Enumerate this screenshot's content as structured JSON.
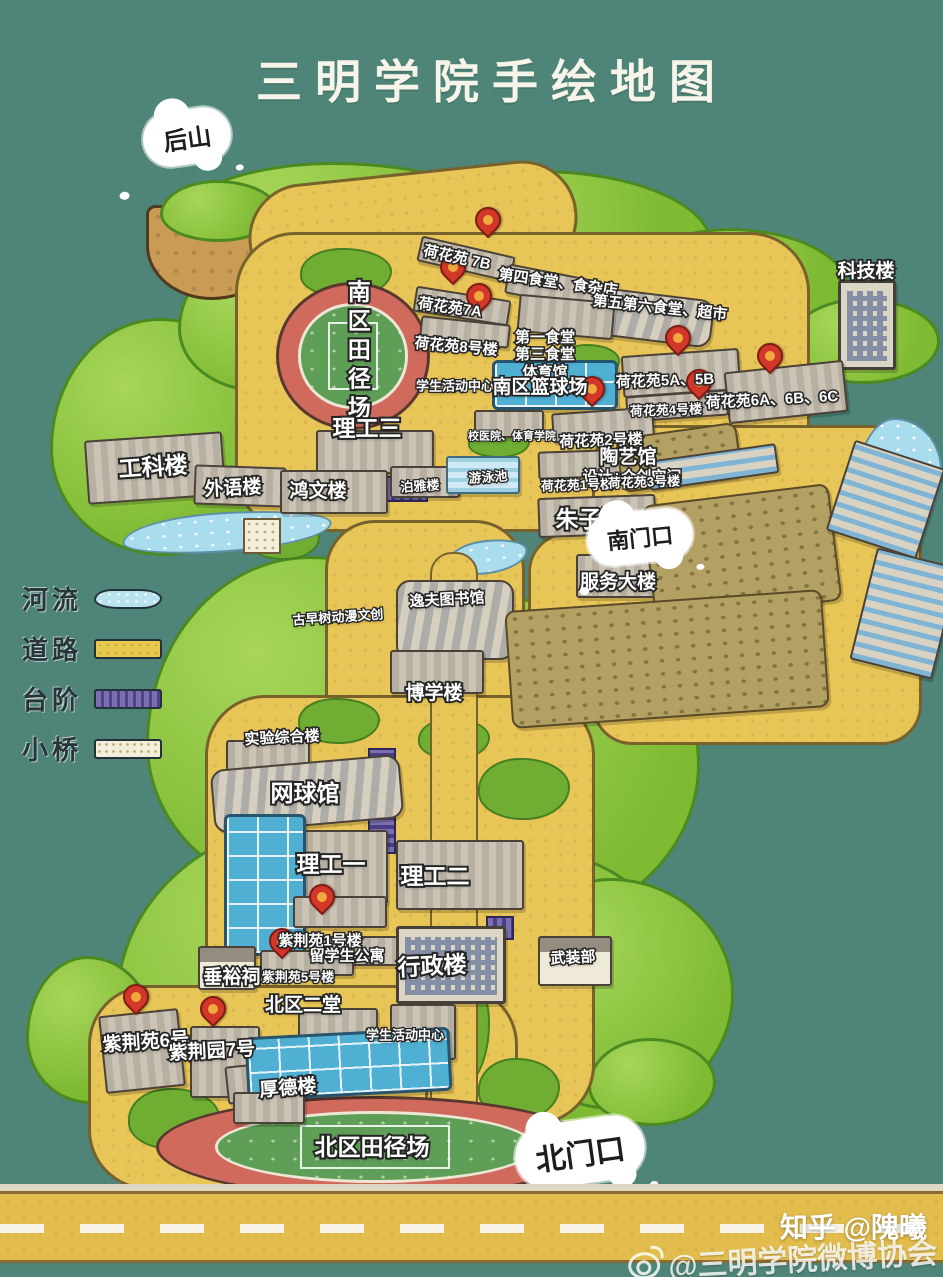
{
  "title": "三明学院手绘地图",
  "colors": {
    "background": "#4f8578",
    "road": "#e8c557",
    "tree": "#7fba33",
    "track": "#cf6a5d",
    "river": "#a9dcec",
    "steps": "#6b5fa3",
    "pin": "#d2372a",
    "bridge": "#f3eeda"
  },
  "legend": {
    "items": [
      {
        "label": "河流",
        "type": "river"
      },
      {
        "label": "道路",
        "type": "road"
      },
      {
        "label": "台阶",
        "type": "steps"
      },
      {
        "label": "小桥",
        "type": "bridge"
      }
    ]
  },
  "clouds": [
    {
      "name": "back-hill-cloud",
      "label": "后山",
      "x": 187,
      "y": 137,
      "fs": 24,
      "rot": -8
    },
    {
      "name": "south-gate-cloud",
      "label": "南门口",
      "x": 640,
      "y": 537,
      "fs": 22,
      "rot": -6
    },
    {
      "name": "north-gate-cloud",
      "label": "北门口",
      "x": 580,
      "y": 1152,
      "fs": 30,
      "rot": -8
    }
  ],
  "watermarks": {
    "zhihu": "知乎 @隗曦",
    "weibo": "@三明学院微博协会"
  },
  "map": {
    "greens": [
      {
        "x": 148,
        "y": 162,
        "w": 385,
        "h": 162
      },
      {
        "x": 378,
        "y": 170,
        "w": 335,
        "h": 152
      },
      {
        "x": 618,
        "y": 228,
        "w": 232,
        "h": 125
      },
      {
        "x": 788,
        "y": 298,
        "w": 152,
        "h": 86
      },
      {
        "x": 50,
        "y": 318,
        "w": 228,
        "h": 238
      },
      {
        "x": 178,
        "y": 252,
        "w": 162,
        "h": 140
      },
      {
        "x": 146,
        "y": 556,
        "w": 342,
        "h": 342
      },
      {
        "x": 328,
        "y": 598,
        "w": 372,
        "h": 332
      },
      {
        "x": 116,
        "y": 818,
        "w": 432,
        "h": 332
      },
      {
        "x": 376,
        "y": 848,
        "w": 312,
        "h": 292
      },
      {
        "x": 496,
        "y": 878,
        "w": 238,
        "h": 232
      },
      {
        "x": 588,
        "y": 1038,
        "w": 128,
        "h": 88
      },
      {
        "x": 26,
        "y": 956,
        "w": 128,
        "h": 148
      }
    ],
    "cliff": {
      "x": 146,
      "y": 205,
      "w": 138,
      "h": 95
    },
    "cliff_top": {
      "x": 160,
      "y": 180,
      "w": 118,
      "h": 62
    },
    "yellows": [
      {
        "x": 248,
        "y": 172,
        "w": 330,
        "h": 112,
        "r": 55,
        "rot": -6
      },
      {
        "x": 235,
        "y": 232,
        "w": 575,
        "h": 300,
        "r": 60
      },
      {
        "x": 325,
        "y": 520,
        "w": 200,
        "h": 270,
        "r": 50
      },
      {
        "x": 205,
        "y": 695,
        "w": 390,
        "h": 430,
        "r": 60
      },
      {
        "x": 88,
        "y": 985,
        "w": 430,
        "h": 205,
        "r": 60
      },
      {
        "x": 425,
        "y": 1085,
        "w": 88,
        "h": 112,
        "r": 10
      },
      {
        "x": 592,
        "y": 425,
        "w": 330,
        "h": 320,
        "r": 40
      },
      {
        "x": 528,
        "y": 532,
        "w": 185,
        "h": 130,
        "r": 40
      }
    ],
    "patches": [
      {
        "x": 300,
        "y": 248,
        "w": 92,
        "h": 50
      },
      {
        "x": 558,
        "y": 344,
        "w": 62,
        "h": 36
      },
      {
        "x": 468,
        "y": 428,
        "w": 62,
        "h": 30
      },
      {
        "x": 248,
        "y": 518,
        "w": 72,
        "h": 42
      },
      {
        "x": 298,
        "y": 698,
        "w": 82,
        "h": 46
      },
      {
        "x": 418,
        "y": 718,
        "w": 72,
        "h": 42
      },
      {
        "x": 478,
        "y": 758,
        "w": 92,
        "h": 62
      },
      {
        "x": 428,
        "y": 966,
        "w": 62,
        "h": 122
      },
      {
        "x": 128,
        "y": 1088,
        "w": 92,
        "h": 62
      },
      {
        "x": 478,
        "y": 1058,
        "w": 82,
        "h": 62
      }
    ],
    "rivers": [
      {
        "x": 122,
        "y": 512,
        "w": 210,
        "h": 40,
        "rot": -4
      },
      {
        "x": 856,
        "y": 418,
        "w": 86,
        "h": 116
      },
      {
        "x": 446,
        "y": 540,
        "w": 82,
        "h": 34,
        "rot": -8
      }
    ],
    "bridges": [
      {
        "x": 243,
        "y": 518,
        "w": 38,
        "h": 36
      }
    ],
    "roads": [
      {
        "x": 430,
        "y": 552,
        "w": 48,
        "h": 568
      }
    ],
    "zebras": [
      {
        "x": 436,
        "y": 1158,
        "w": 82,
        "h": 34
      }
    ],
    "tracks": [
      {
        "name": "south-track-field",
        "x": 276,
        "y": 282,
        "w": 154,
        "h": 148
      },
      {
        "name": "north-track-field",
        "x": 156,
        "y": 1096,
        "w": 438,
        "h": 102
      }
    ],
    "steps": [
      {
        "x": 366,
        "y": 476,
        "w": 62,
        "h": 26
      },
      {
        "x": 368,
        "y": 748,
        "w": 28,
        "h": 106
      },
      {
        "x": 486,
        "y": 916,
        "w": 28,
        "h": 24
      },
      {
        "x": 412,
        "y": 1020,
        "w": 32,
        "h": 44
      }
    ],
    "buildings": [
      {
        "name": "hehuayuan-7b",
        "x": 418,
        "y": 246,
        "w": 96,
        "h": 26,
        "rot": 13,
        "type": "g"
      },
      {
        "name": "canteen-4",
        "x": 506,
        "y": 272,
        "w": 92,
        "h": 30,
        "rot": 11,
        "type": "g"
      },
      {
        "name": "canteen-5-6",
        "x": 601,
        "y": 294,
        "w": 112,
        "h": 48,
        "rot": 7,
        "type": "h"
      },
      {
        "name": "hehuayuan-7a",
        "x": 414,
        "y": 293,
        "w": 96,
        "h": 26,
        "rot": 9,
        "type": "g"
      },
      {
        "name": "hehuayuan-8",
        "x": 420,
        "y": 320,
        "w": 90,
        "h": 24,
        "rot": 6,
        "type": "g"
      },
      {
        "name": "canteen-1-3-gym",
        "x": 518,
        "y": 298,
        "w": 96,
        "h": 38,
        "rot": 5,
        "type": "g"
      },
      {
        "name": "keji-tower",
        "x": 838,
        "y": 280,
        "w": 58,
        "h": 90,
        "type": "t"
      },
      {
        "name": "hehuayuan-5a-5b",
        "x": 622,
        "y": 352,
        "w": 118,
        "h": 42,
        "rot": -4,
        "type": "g"
      },
      {
        "name": "hehuayuan-6abc",
        "x": 726,
        "y": 366,
        "w": 120,
        "h": 52,
        "rot": -6,
        "type": "g"
      },
      {
        "name": "hehuayuan-4",
        "x": 626,
        "y": 393,
        "w": 102,
        "h": 26,
        "rot": -4,
        "type": "g"
      },
      {
        "name": "basketball-courts-south",
        "x": 492,
        "y": 360,
        "w": 126,
        "h": 50,
        "type": "c"
      },
      {
        "name": "school-hospital",
        "x": 474,
        "y": 410,
        "w": 70,
        "h": 28,
        "type": "g"
      },
      {
        "name": "hehuayuan-2",
        "x": 552,
        "y": 410,
        "w": 102,
        "h": 30,
        "rot": -4,
        "type": "g"
      },
      {
        "name": "hehuayuan-1",
        "x": 538,
        "y": 450,
        "w": 102,
        "h": 28,
        "rot": -2,
        "type": "g"
      },
      {
        "name": "hehuayuan-3",
        "x": 620,
        "y": 450,
        "w": 80,
        "h": 26,
        "rot": -2,
        "type": "g"
      },
      {
        "name": "zhuziyuan-hall",
        "x": 538,
        "y": 496,
        "w": 118,
        "h": 40,
        "rot": -2,
        "type": "g"
      },
      {
        "name": "ligong-3",
        "x": 316,
        "y": 430,
        "w": 118,
        "h": 44,
        "type": "g"
      },
      {
        "name": "gongke-building",
        "x": 86,
        "y": 436,
        "w": 138,
        "h": 64,
        "rot": -4,
        "type": "g"
      },
      {
        "name": "waiyu-building",
        "x": 194,
        "y": 466,
        "w": 92,
        "h": 40,
        "rot": 2,
        "type": "g"
      },
      {
        "name": "hongwen-building",
        "x": 280,
        "y": 470,
        "w": 108,
        "h": 44,
        "type": "g"
      },
      {
        "name": "boya-building",
        "x": 390,
        "y": 466,
        "w": 70,
        "h": 32,
        "type": "g"
      },
      {
        "name": "swimming-pool",
        "x": 446,
        "y": 456,
        "w": 74,
        "h": 38,
        "type": "p"
      },
      {
        "name": "service-building",
        "x": 576,
        "y": 554,
        "w": 94,
        "h": 44,
        "type": "g"
      },
      {
        "name": "library",
        "x": 396,
        "y": 580,
        "w": 118,
        "h": 80,
        "type": "h"
      },
      {
        "name": "boxue-building",
        "x": 390,
        "y": 650,
        "w": 94,
        "h": 44,
        "type": "g"
      },
      {
        "name": "shiyan-building",
        "x": 226,
        "y": 740,
        "w": 84,
        "h": 54,
        "type": "g"
      },
      {
        "name": "tennis-hall",
        "x": 212,
        "y": 762,
        "w": 190,
        "h": 64,
        "rot": -5,
        "type": "h"
      },
      {
        "name": "ligong-1",
        "x": 276,
        "y": 830,
        "w": 112,
        "h": 74,
        "type": "g"
      },
      {
        "name": "ligong-2",
        "x": 396,
        "y": 840,
        "w": 128,
        "h": 70,
        "type": "g"
      },
      {
        "name": "basketball-courts-west",
        "x": 224,
        "y": 814,
        "w": 82,
        "h": 142,
        "type": "c"
      },
      {
        "name": "zijing-1",
        "x": 293,
        "y": 896,
        "w": 94,
        "h": 32,
        "type": "g"
      },
      {
        "name": "intl-student-apartment",
        "x": 320,
        "y": 936,
        "w": 118,
        "h": 30,
        "type": "g"
      },
      {
        "name": "zijing-5",
        "x": 260,
        "y": 950,
        "w": 94,
        "h": 26,
        "type": "g"
      },
      {
        "name": "chuiyu-shrine",
        "x": 198,
        "y": 946,
        "w": 58,
        "h": 44,
        "type": "hs"
      },
      {
        "name": "admin-building",
        "x": 396,
        "y": 926,
        "w": 110,
        "h": 78,
        "type": "t"
      },
      {
        "name": "wuzhuang-house",
        "x": 538,
        "y": 936,
        "w": 74,
        "h": 50,
        "type": "hs"
      },
      {
        "name": "beiqu-ertang",
        "x": 298,
        "y": 1008,
        "w": 80,
        "h": 44,
        "type": "g"
      },
      {
        "name": "student-activity-north",
        "x": 390,
        "y": 1004,
        "w": 66,
        "h": 56,
        "type": "g"
      },
      {
        "name": "zijing-6",
        "x": 102,
        "y": 1012,
        "w": 80,
        "h": 78,
        "rot": -6,
        "type": "g"
      },
      {
        "name": "zijing-7",
        "x": 190,
        "y": 1026,
        "w": 70,
        "h": 72,
        "type": "g"
      },
      {
        "name": "houde-building",
        "x": 226,
        "y": 1060,
        "w": 128,
        "h": 38,
        "rot": -6,
        "type": "g"
      },
      {
        "name": "basketball-courts-north",
        "x": 246,
        "y": 1032,
        "w": 205,
        "h": 64,
        "rot": -3,
        "type": "c"
      },
      {
        "name": "small-building-bottom",
        "x": 233,
        "y": 1092,
        "w": 72,
        "h": 32,
        "type": "g"
      },
      {
        "name": "field-upper",
        "x": 618,
        "y": 430,
        "w": 122,
        "h": 55,
        "rot": -8,
        "type": "f"
      },
      {
        "name": "greenhouse-top",
        "x": 648,
        "y": 452,
        "w": 130,
        "h": 30,
        "rot": -8,
        "type": "st"
      },
      {
        "name": "field-1",
        "x": 648,
        "y": 494,
        "w": 188,
        "h": 118,
        "rot": -7,
        "type": "f"
      },
      {
        "name": "field-2",
        "x": 508,
        "y": 600,
        "w": 318,
        "h": 118,
        "rot": -4,
        "type": "f"
      },
      {
        "name": "greenhouse-right-1",
        "x": 838,
        "y": 452,
        "w": 95,
        "h": 95,
        "rot": 18,
        "type": "st"
      },
      {
        "name": "greenhouse-right-2",
        "x": 862,
        "y": 556,
        "w": 85,
        "h": 115,
        "rot": 14,
        "type": "st"
      }
    ],
    "pins": [
      {
        "x": 488,
        "y": 240,
        "for": "荷花苑 7B"
      },
      {
        "x": 453,
        "y": 287,
        "for": "荷花苑7A"
      },
      {
        "x": 479,
        "y": 316,
        "for": "荷花苑8号楼"
      },
      {
        "x": 678,
        "y": 358,
        "for": "荷花苑5A、5B"
      },
      {
        "x": 770,
        "y": 376,
        "for": "荷花苑6A、6B、6C"
      },
      {
        "x": 699,
        "y": 402,
        "for": "荷花苑4号楼"
      },
      {
        "x": 592,
        "y": 409,
        "for": "荷花苑2号楼"
      },
      {
        "x": 322,
        "y": 917,
        "for": "紫荆苑1号楼"
      },
      {
        "x": 282,
        "y": 961,
        "for": "紫荆苑5号楼"
      },
      {
        "x": 136,
        "y": 1017,
        "for": "紫荆苑6号"
      },
      {
        "x": 213,
        "y": 1029,
        "for": "紫荆园7号"
      }
    ],
    "labels": [
      {
        "text": "荷花苑 7B",
        "x": 457,
        "y": 258,
        "size": "m",
        "rot": 12
      },
      {
        "text": "第四食堂、食杂店",
        "x": 558,
        "y": 283,
        "size": "m",
        "rot": 8
      },
      {
        "text": "荷花苑7A",
        "x": 450,
        "y": 308,
        "size": "m",
        "rot": 8
      },
      {
        "text": "第五第六食堂、超市",
        "x": 660,
        "y": 308,
        "size": "m",
        "rot": 6
      },
      {
        "text": "荷花苑8号楼",
        "x": 456,
        "y": 347,
        "size": "m",
        "rot": 5
      },
      {
        "text": "第一食堂\n第三食堂\n体育馆",
        "x": 545,
        "y": 355,
        "size": "m"
      },
      {
        "text": "科技楼",
        "x": 866,
        "y": 272,
        "size": "l"
      },
      {
        "text": "南区田径场",
        "x": 357,
        "y": 352,
        "size": "xl",
        "vertical": true
      },
      {
        "text": "学生活动中心",
        "x": 455,
        "y": 387,
        "size": "s"
      },
      {
        "text": "南区篮球场",
        "x": 540,
        "y": 388,
        "size": "l"
      },
      {
        "text": "荷花苑5A、5B",
        "x": 665,
        "y": 381,
        "size": "m",
        "rot": -2
      },
      {
        "text": "荷花苑6A、6B、6C",
        "x": 772,
        "y": 400,
        "size": "m",
        "rot": -3
      },
      {
        "text": "荷花苑4号楼",
        "x": 666,
        "y": 411,
        "size": "s",
        "rot": -2
      },
      {
        "text": "理工三",
        "x": 367,
        "y": 428,
        "size": "xl"
      },
      {
        "text": "校医院、体育学院",
        "x": 512,
        "y": 437,
        "size": "xs"
      },
      {
        "text": "荷花苑2号楼",
        "x": 601,
        "y": 441,
        "size": "m",
        "rot": -2
      },
      {
        "text": "陶艺馆",
        "x": 628,
        "y": 458,
        "size": "l"
      },
      {
        "text": "设计+众创空间",
        "x": 632,
        "y": 477,
        "size": "m"
      },
      {
        "text": "工科楼",
        "x": 153,
        "y": 467,
        "size": "xl",
        "rot": -4
      },
      {
        "text": "外语楼",
        "x": 233,
        "y": 489,
        "size": "l",
        "rot": -3
      },
      {
        "text": "鸿文楼",
        "x": 318,
        "y": 492,
        "size": "l"
      },
      {
        "text": "泊雅楼",
        "x": 420,
        "y": 487,
        "size": "s",
        "rot": -4
      },
      {
        "text": "游泳池",
        "x": 488,
        "y": 478,
        "size": "s",
        "rot": -4
      },
      {
        "text": "荷花苑1号楼",
        "x": 577,
        "y": 486,
        "size": "s",
        "rot": -2
      },
      {
        "text": "荷花苑3号楼",
        "x": 644,
        "y": 483,
        "size": "s",
        "rot": -2
      },
      {
        "text": "朱子园",
        "x": 590,
        "y": 519,
        "size": "xl"
      },
      {
        "text": "服务大楼",
        "x": 618,
        "y": 583,
        "size": "l"
      },
      {
        "text": "古早树动漫文创",
        "x": 338,
        "y": 618,
        "size": "s",
        "rot": -4
      },
      {
        "text": "逸夫图书馆",
        "x": 447,
        "y": 600,
        "size": "m",
        "rot": -3
      },
      {
        "text": "博学楼",
        "x": 434,
        "y": 694,
        "size": "l"
      },
      {
        "text": "实验综合楼",
        "x": 282,
        "y": 738,
        "size": "m",
        "rot": -3
      },
      {
        "text": "网球馆",
        "x": 305,
        "y": 793,
        "size": "xl"
      },
      {
        "text": "理工一",
        "x": 331,
        "y": 864,
        "size": "xl"
      },
      {
        "text": "理工二",
        "x": 435,
        "y": 876,
        "size": "xl"
      },
      {
        "text": "紫荆苑1号楼",
        "x": 320,
        "y": 941,
        "size": "m"
      },
      {
        "text": "留学生公寓",
        "x": 347,
        "y": 956,
        "size": "m"
      },
      {
        "text": "紫荆苑5号楼",
        "x": 298,
        "y": 978,
        "size": "s"
      },
      {
        "text": "垂裕祠",
        "x": 232,
        "y": 978,
        "size": "l"
      },
      {
        "text": "行政楼",
        "x": 432,
        "y": 966,
        "size": "xl",
        "rot": -3
      },
      {
        "text": "武装部",
        "x": 573,
        "y": 958,
        "size": "m",
        "rot": -3
      },
      {
        "text": "北区二堂",
        "x": 303,
        "y": 1006,
        "size": "l"
      },
      {
        "text": "学生活动中心",
        "x": 405,
        "y": 1036,
        "size": "s"
      },
      {
        "text": "紫荆苑6号",
        "x": 146,
        "y": 1043,
        "size": "l",
        "rot": -4
      },
      {
        "text": "紫荆园7号",
        "x": 212,
        "y": 1052,
        "size": "l",
        "rot": -3
      },
      {
        "text": "厚德楼",
        "x": 288,
        "y": 1089,
        "size": "l",
        "rot": -5
      },
      {
        "text": "北区田径场",
        "x": 372,
        "y": 1147,
        "size": "xl"
      }
    ]
  }
}
